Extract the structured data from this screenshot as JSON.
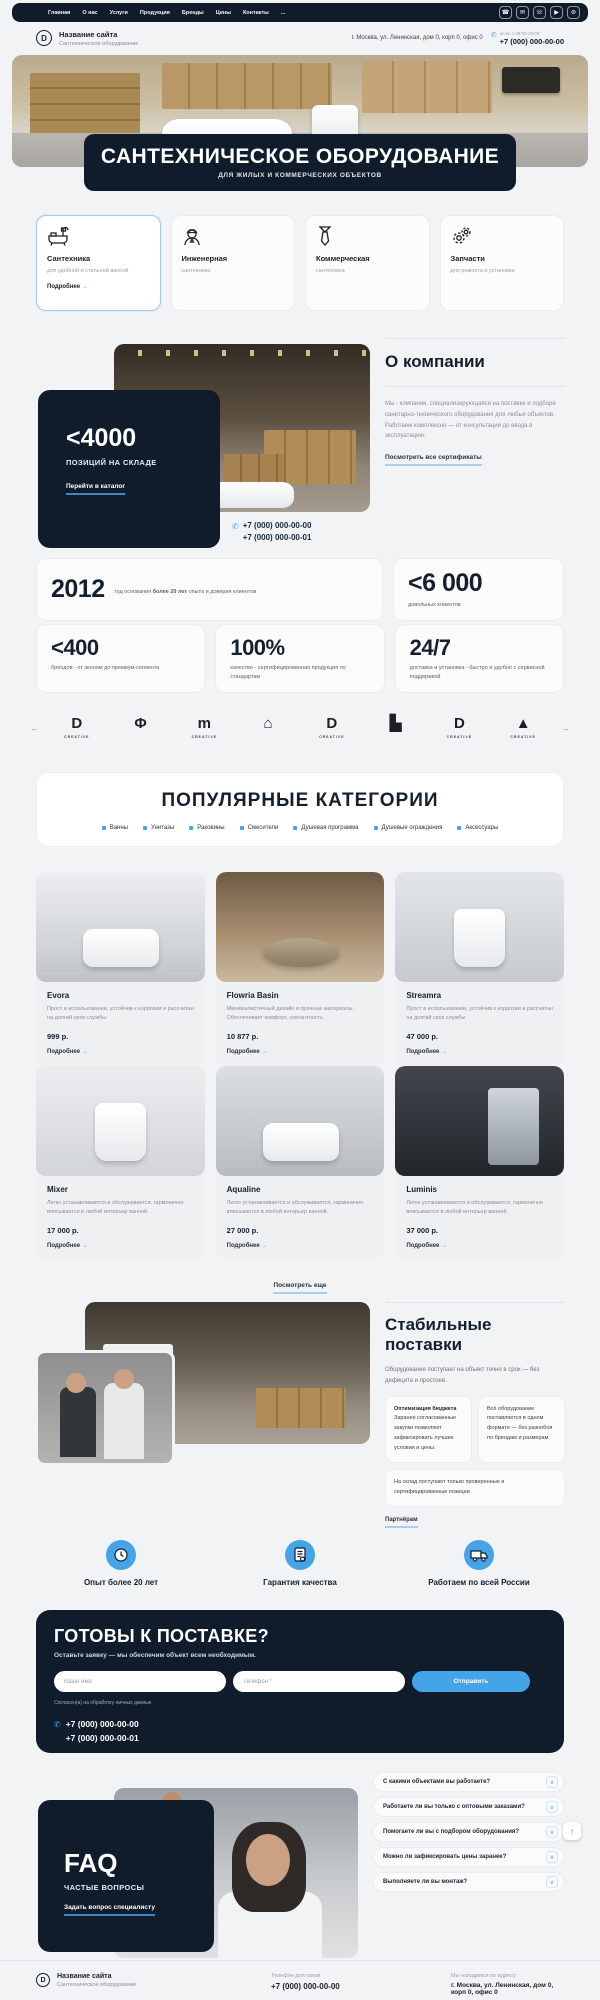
{
  "colors": {
    "navy": "#101c2c",
    "accent": "#45a3e8",
    "page_bg": "#f2f3f5"
  },
  "icons": {
    "arrow_right": "→",
    "arrow_left": "←",
    "arrow_up": "↑",
    "chevron_down": "∨",
    "phone": "✆",
    "nav_phone": "☎",
    "nav_mail": "✉",
    "nav_whatsapp": "☏",
    "nav_telegram": "▶",
    "nav_viber": "⊚"
  },
  "topnav": {
    "items": [
      "Главная",
      "О нас",
      "Услуги",
      "Продукция",
      "Бренды",
      "Цены",
      "Контакты",
      "..."
    ]
  },
  "header": {
    "logo_text": "D",
    "site_name": "Название сайта",
    "site_tagline": "Сантехническое оборудование",
    "address": "г. Москва, ул. Ленинская, дом 0, корп 0, офис 0",
    "hours": "пн-вс с 08:00-20:00",
    "phone": "+7 (000) 000-00-00"
  },
  "hero": {
    "title": "САНТЕХНИЧЕСКОЕ ОБОРУДОВАНИЕ",
    "subtitle": "ДЛЯ ЖИЛЫХ И КОММЕРЧЕСКИХ ОБЪЕКТОВ"
  },
  "categories": [
    {
      "title": "Сантехника",
      "subtitle": "для удобной и стильной ванной",
      "more": "Подробнее",
      "icon": "bathtub-icon"
    },
    {
      "title": "Инженерная",
      "subtitle": "сантехника",
      "icon": "engineer-icon"
    },
    {
      "title": "Коммерческая",
      "subtitle": "сантехника",
      "icon": "tie-icon"
    },
    {
      "title": "Запчасти",
      "subtitle": "для ремонта и установки",
      "icon": "gears-icon"
    }
  ],
  "about": {
    "stock_value": "<4000",
    "stock_label": "ПОЗИЦИЙ НА СКЛАДЕ",
    "catalog_link": "Перейти в каталог",
    "phone1": "+7 (000) 000-00-00",
    "phone2": "+7 (000) 000-00-01",
    "heading": "О компании",
    "text": "Мы - компания, специализирующаяся на поставке и подборе санитарно-технического оборудования для любых объектов. Работаем комплексно — от консультации до ввода в эксплуатацию.",
    "certificates_link": "Посмотреть все сертификаты"
  },
  "stats": [
    {
      "value": "2012",
      "label_prefix": "год основания ",
      "label_bold": "более 20 лет",
      "label_suffix": " опыта и доверия клиентов"
    },
    {
      "value": "<6 000",
      "label": "довольных клиентов"
    },
    {
      "value": "<400",
      "label": "брендов - от эконом до премиум-сегмента"
    },
    {
      "value": "100%",
      "label": "качество - сертифицированная продукция по стандартам"
    },
    {
      "value": "24/7",
      "label": "доставка и установка - быстро и удобно с сервисной поддержкой"
    }
  ],
  "brands": {
    "items": [
      {
        "glyph": "D",
        "caption": "CREATIVE"
      },
      {
        "glyph": "Φ"
      },
      {
        "glyph": "m",
        "caption": "CREATIVE"
      },
      {
        "glyph": "⌂"
      },
      {
        "glyph": "D",
        "caption": "CREATIVE"
      },
      {
        "glyph": "▙"
      },
      {
        "glyph": "D",
        "caption": "CREATIVE"
      },
      {
        "glyph": "▲",
        "caption": "CREATIVE"
      }
    ]
  },
  "popular": {
    "heading": "ПОПУЛЯРНЫЕ КАТЕГОРИИ",
    "chips": [
      "Ванны",
      "Унитазы",
      "Раковины",
      "Смесители",
      "Душевая программа",
      "Душевые ограждения",
      "Аксессуары"
    ]
  },
  "products": [
    {
      "title": "Evora",
      "desc": "Прост в использовании, устойчив к коррозии и рассчитан на долгий срок службы",
      "price": "999 р.",
      "more": "Подробнее"
    },
    {
      "title": "Flowria Basin",
      "desc": "Минималистичный дизайн и прочные материалы. Обеспечивает комфорт, элегантность",
      "price": "10 877 р.",
      "more": "Подробнее"
    },
    {
      "title": "Streamra",
      "desc": "Прост в использовании, устойчив к коррозии и рассчитан на долгий срок службы",
      "price": "47 000 р.",
      "more": "Подробнее"
    },
    {
      "title": "Mixer",
      "desc": "Легко устанавливается и обслуживается, гармонично вписывается в любой интерьер ванной.",
      "price": "17 000 р.",
      "more": "Подробнее"
    },
    {
      "title": "Aqualine",
      "desc": "Легко устанавливается и обслуживается, гармонично вписывается в любой интерьер ванной.",
      "price": "27 000 р.",
      "more": "Подробнее"
    },
    {
      "title": "Luminis",
      "desc": "Легко устанавливается и обслуживается, гармонично вписывается в любой интерьер ванной.",
      "price": "37 000 р.",
      "more": "Подробнее"
    }
  ],
  "show_more": "Посмотреть еще",
  "supply": {
    "heading": "Стабильные поставки",
    "intro": "Оборудование поступает на объект точно в срок — без дефицита и простоев.",
    "card1_title": "Оптимизация бюджета",
    "card1_text": "Заранее согласованные закупки позволяют зафиксировать лучшие условия и цены.",
    "card2_text": "Всё оборудование поставляется в одном формате — без разнобоя по брендам и размерам",
    "card3_text": "На склад поступают только проверенные и сертифицированные позиции.",
    "partners_link": "Партнёрам"
  },
  "features": [
    {
      "label": "Опыт более 20 лет",
      "icon": "clock-icon"
    },
    {
      "label": "Гарантия качества",
      "icon": "certificate-icon"
    },
    {
      "label": "Работаем по всей России",
      "icon": "truck-icon"
    }
  ],
  "cta": {
    "heading": "ГОТОВЫ К ПОСТАВКЕ?",
    "subtitle": "Оставьте заявку — мы обеспечим объект всем необходимым.",
    "name_placeholder": "Ваше имя",
    "phone_placeholder": "Телефон *",
    "submit_label": "Отправить",
    "consent": "Согласен(а) на обработку личных данных",
    "phone1": "+7 (000) 000-00-00",
    "phone2": "+7 (000) 000-00-01"
  },
  "faq": {
    "title": "FAQ",
    "subtitle": "ЧАСТЫЕ ВОПРОСЫ",
    "link": "Задать вопрос специалисту",
    "questions": [
      "С какими объектами вы работаете?",
      "Работаете ли вы только с оптовыми заказами?",
      "Помогаете ли вы с подбором оборудования?",
      "Можно ли зафиксировать цены заранее?",
      "Выполняете ли вы монтаж?"
    ]
  },
  "footer": {
    "logo_text": "D",
    "site_name": "Название сайта",
    "site_tagline": "Сантехническое оборудование",
    "phone_label": "Телефон для связи",
    "phone": "+7 (000) 000-00-00",
    "address_label": "Мы находимся по адресу:",
    "address": "г. Москва, ул. Ленинская, дом 0, корп 0, офис 0"
  }
}
